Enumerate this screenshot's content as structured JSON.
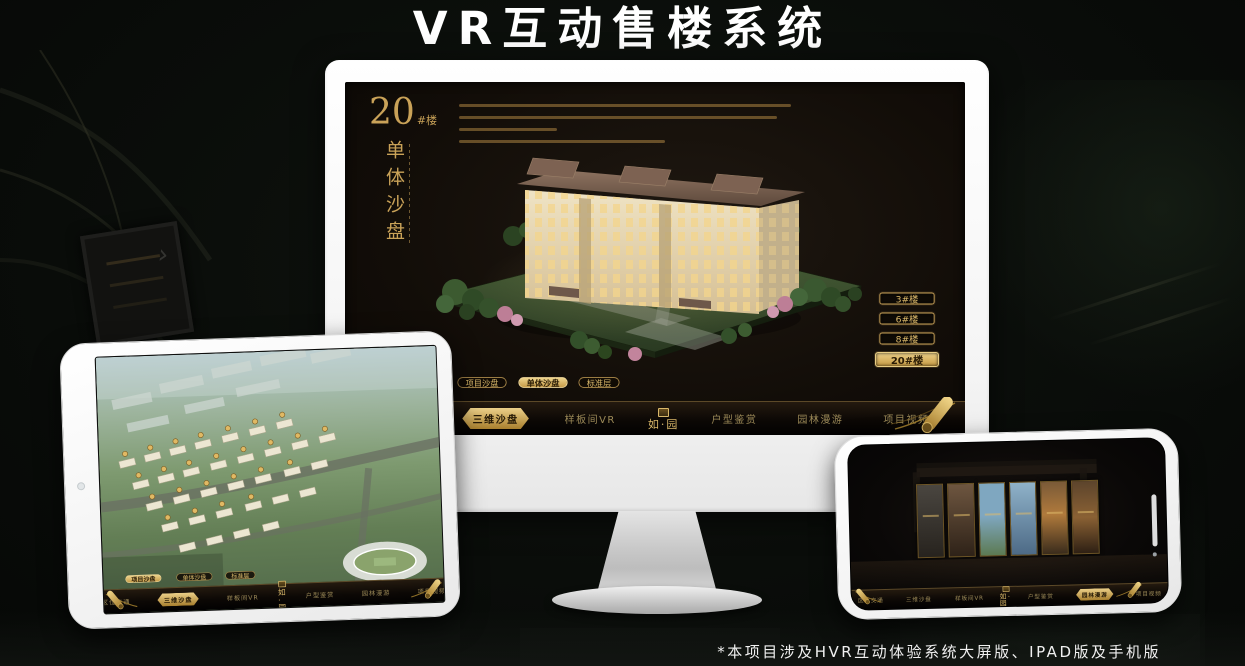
{
  "title": {
    "text": "VR互动售楼系统"
  },
  "footnote": {
    "text": "*本项目涉及HVR互动体验系统大屏版、IPAD版及手机版"
  },
  "colors": {
    "gold": "#c9a258",
    "gold_bright": "#e8cd84",
    "screen_bg": "#140f09",
    "title_white": "#ffffff"
  },
  "monitor": {
    "headline": {
      "number": "20",
      "suffix": "#楼",
      "vertical_title": "单体沙盘"
    },
    "floor_buttons": [
      {
        "label": "3#楼",
        "selected": false
      },
      {
        "label": "6#楼",
        "selected": false
      },
      {
        "label": "8#楼",
        "selected": false
      },
      {
        "label": "20#楼",
        "selected": true
      }
    ],
    "tabs": [
      {
        "label": "项目沙盘",
        "selected": false
      },
      {
        "label": "单体沙盘",
        "selected": true
      },
      {
        "label": "标准层",
        "selected": false
      }
    ],
    "nav": {
      "logo": "如·园",
      "items": [
        {
          "label": "区位交通",
          "selected": false
        },
        {
          "label": "三维沙盘",
          "selected": true
        },
        {
          "label": "样板间VR",
          "selected": false
        },
        {
          "label": "户型鉴赏",
          "selected": false
        },
        {
          "label": "园林漫游",
          "selected": false
        },
        {
          "label": "项目视频",
          "selected": false
        }
      ]
    }
  },
  "tablet": {
    "tabs": [
      {
        "label": "项目沙盘",
        "selected": true
      },
      {
        "label": "单体沙盘",
        "selected": false
      },
      {
        "label": "标准层",
        "selected": false
      }
    ],
    "nav": {
      "logo": "如·园",
      "items": [
        {
          "label": "区位交通",
          "selected": false
        },
        {
          "label": "三维沙盘",
          "selected": true
        },
        {
          "label": "样板间VR",
          "selected": false
        },
        {
          "label": "户型鉴赏",
          "selected": false
        },
        {
          "label": "园林漫游",
          "selected": false
        },
        {
          "label": "项目视频",
          "selected": false
        }
      ]
    }
  },
  "phone": {
    "nav": {
      "logo": "如·园",
      "items": [
        {
          "label": "区位交通",
          "selected": false
        },
        {
          "label": "三维沙盘",
          "selected": false
        },
        {
          "label": "样板间VR",
          "selected": false
        },
        {
          "label": "户型鉴赏",
          "selected": false
        },
        {
          "label": "园林漫游",
          "selected": true
        },
        {
          "label": "项目视频",
          "selected": false
        }
      ]
    }
  }
}
